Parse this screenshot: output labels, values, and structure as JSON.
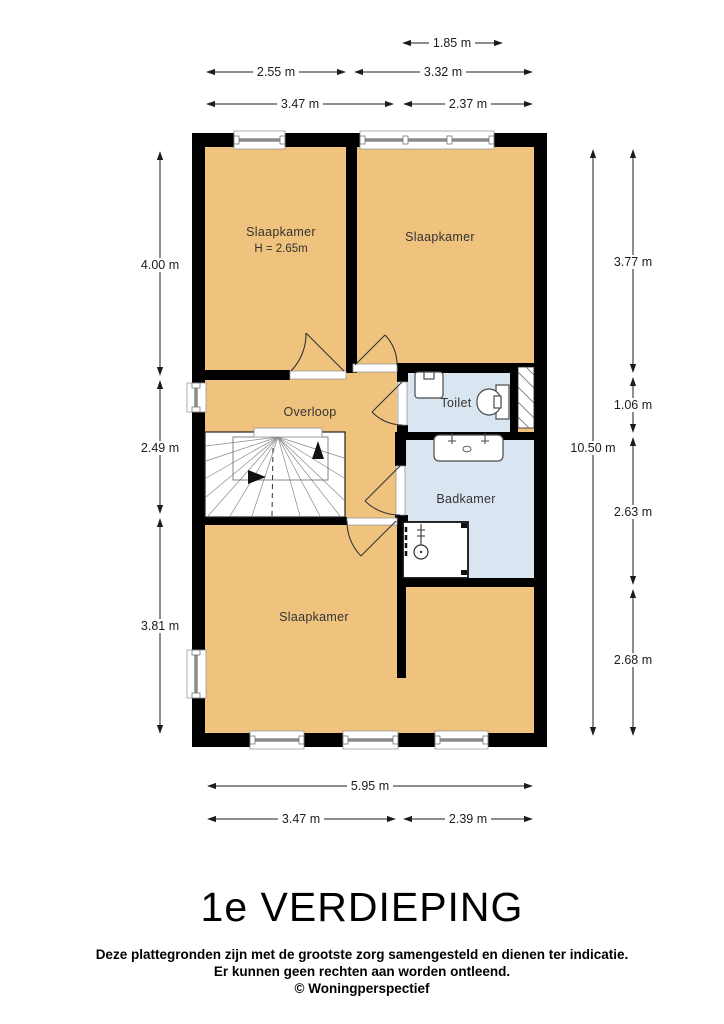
{
  "page": {
    "title": "1e VERDIEPING",
    "disclaimer": {
      "line1": "Deze plattegronden zijn met de grootste zorg samengesteld en dienen ter indicatie.",
      "line2": "Er kunnen geen rechten aan worden ontleend.",
      "line3": "© Woningperspectief"
    }
  },
  "floorplan": {
    "colors": {
      "wall": "#000000",
      "room_warm": "#efc37e",
      "room_wet": "#d9e5f0"
    },
    "rooms": [
      {
        "id": "slaapkamer-top-left",
        "label": "Slaapkamer",
        "height_note": "H = 2.65m"
      },
      {
        "id": "slaapkamer-top-right",
        "label": "Slaapkamer"
      },
      {
        "id": "overloop",
        "label": "Overloop"
      },
      {
        "id": "toilet",
        "label": "Toilet"
      },
      {
        "id": "badkamer",
        "label": "Badkamer"
      },
      {
        "id": "slaapkamer-bottom",
        "label": "Slaapkamer"
      }
    ],
    "dimensions": {
      "top": [
        {
          "label": "1.85 m"
        },
        {
          "label": "2.55 m"
        },
        {
          "label": "3.32 m"
        },
        {
          "label": "3.47 m"
        },
        {
          "label": "2.37 m"
        }
      ],
      "left": [
        {
          "label": "4.00 m"
        },
        {
          "label": "2.49 m"
        },
        {
          "label": "3.81 m"
        }
      ],
      "right": [
        {
          "label": "3.77 m"
        },
        {
          "label": "1.06 m"
        },
        {
          "label": "2.63 m"
        },
        {
          "label": "2.68 m"
        },
        {
          "label": "10.50 m"
        }
      ],
      "bottom": [
        {
          "label": "5.95 m"
        },
        {
          "label": "3.47 m"
        },
        {
          "label": "2.39 m"
        }
      ]
    }
  }
}
